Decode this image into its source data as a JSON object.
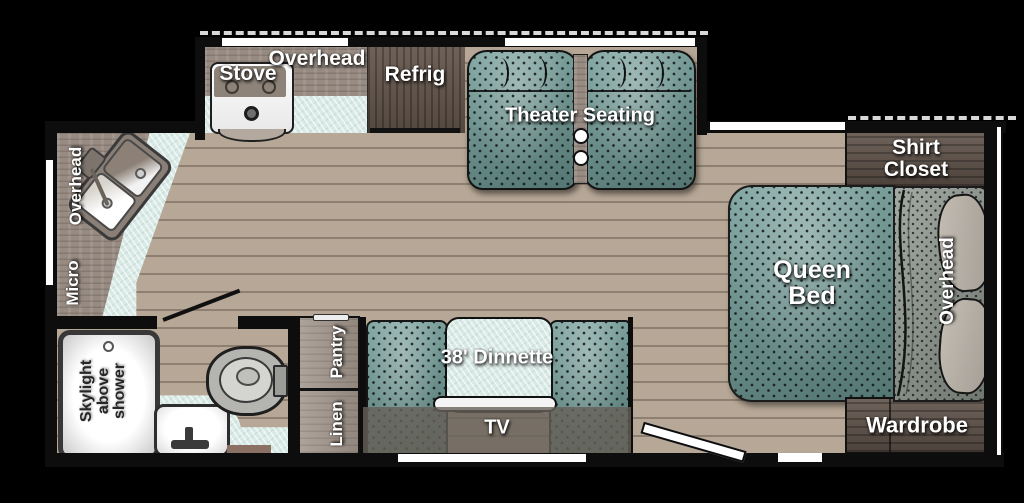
{
  "labels": {
    "kitchen_overhead": "Overhead",
    "stove": "Stove",
    "refrig": "Refrig",
    "theater_seating": "Theater Seating",
    "shirt_closet": "Shirt\nCloset",
    "queen_bed": "Queen\nBed",
    "bedroom_overhead": "Overhead",
    "wardrobe": "Wardrobe",
    "dinette": "38' Dinnette",
    "tv": "TV",
    "pantry": "Pantry",
    "linen": "Linen",
    "left_overhead": "Overhead",
    "micro": "Micro",
    "skylight": "Skylight\nabove\nshower"
  },
  "colors": {
    "background": "#000000",
    "floor_tan": "#b6a796",
    "upholstery_teal": "#6b9792",
    "counter_mint": "#d9eae6",
    "dark_wood": "#5e5148",
    "cabinet_gray": "#988b82",
    "wall_black": "#0d0d0d",
    "window_white": "#ffffff"
  }
}
